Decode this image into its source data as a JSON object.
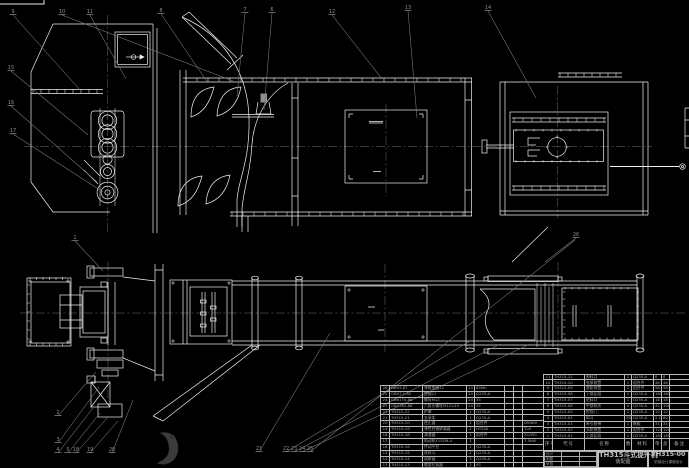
{
  "drawing": {
    "colors": {
      "background": "#000000",
      "line": "#f0f0f0",
      "leader": "#7d7d7d",
      "text": "#a6a6a6"
    },
    "watermark": "ink-blot-logo"
  },
  "title_block": {
    "title": "TH315斗式提升机",
    "subtitle": "装配图",
    "drawing_no": "TH315-00",
    "org_line": "机械设计课程设计",
    "sign_labels": [
      "设计",
      "制图",
      "审核"
    ]
  },
  "bom": {
    "headers": [
      "序号",
      "代号",
      "名称",
      "数量",
      "材料",
      "单件",
      "总计",
      "备注"
    ],
    "right_rows": [
      [
        "11",
        "TH315-11",
        "卸料口",
        "1",
        "Q235-A",
        "8",
        "8",
        ""
      ],
      [
        "10",
        "TH315-10",
        "张紧装置",
        "1",
        "组合件",
        "46",
        "46",
        ""
      ],
      [
        "9",
        "TH315-09",
        "底轮装置",
        "1",
        "组合件",
        "58",
        "58",
        ""
      ],
      [
        "8",
        "TH315-08",
        "下部区段",
        "1",
        "Q235-A",
        "165",
        "165",
        ""
      ],
      [
        "7",
        "TH315-07",
        "进料口",
        "1",
        "Q235-A",
        "18",
        "18",
        ""
      ],
      [
        "6",
        "TH315-06",
        "中部机壳",
        "4",
        "Q235-A",
        "42",
        "168",
        ""
      ],
      [
        "5",
        "TH315-05",
        "检视门",
        "1",
        "Q235-A",
        "12",
        "12",
        ""
      ],
      [
        "4",
        "TH315-04",
        "料斗",
        "38",
        "Q235-A",
        "2.1",
        "80",
        ""
      ],
      [
        "3",
        "TH315-03",
        "牵引胶带",
        "1",
        "橡胶",
        "35",
        "35",
        ""
      ],
      [
        "2",
        "TH315-02",
        "头轮装置",
        "1",
        "组合件",
        "120",
        "120",
        ""
      ],
      [
        "1",
        "TH315-01",
        "上部区段",
        "1",
        "Q235-A",
        "185",
        "185",
        ""
      ]
    ],
    "left_rows": [
      [
        "26",
        "GB93-87",
        "弹簧垫圈12",
        "24",
        "65Mn",
        "",
        "",
        ""
      ],
      [
        "25",
        "GB97.1-85",
        "垫圈12",
        "24",
        "Q235-A",
        "",
        "",
        ""
      ],
      [
        "24",
        "GB6170-86",
        "螺母M12",
        "24",
        "35",
        "",
        "",
        ""
      ],
      [
        "23",
        "GB5782-86",
        "六角头螺栓M12×45",
        "24",
        "35",
        "",
        "",
        ""
      ],
      [
        "22",
        "TH315-22",
        "护罩",
        "1",
        "Q235-A",
        "",
        "",
        ""
      ],
      [
        "21",
        "TH315-21",
        "支承架",
        "1",
        "Q235-A",
        "",
        "",
        ""
      ],
      [
        "20",
        "TH315-20",
        "逆止器",
        "1",
        "组合件",
        "",
        "",
        "DSN60"
      ],
      [
        "19",
        "TH315-19",
        "弹性柱销联轴器",
        "1",
        "HT200",
        "",
        "",
        "TL6"
      ],
      [
        "18",
        "TH315-18",
        "减速器",
        "1",
        "组合件",
        "",
        "",
        "ZQ350"
      ],
      [
        "17",
        "",
        "电动机Y132M-4",
        "1",
        "",
        "",
        "",
        "7.5kW"
      ],
      [
        "16",
        "TH315-16",
        "传动平台",
        "1",
        "Q235-A",
        "",
        "",
        ""
      ],
      [
        "15",
        "TH315-15",
        "进料斗",
        "1",
        "Q235-A",
        "",
        "",
        ""
      ],
      [
        "14",
        "TH315-14",
        "观察窗",
        "2",
        "Q235-A",
        "",
        "",
        ""
      ],
      [
        "13",
        "TH315-13",
        "螺旋拉紧器",
        "2",
        "45",
        "",
        "",
        ""
      ],
      [
        "12",
        "TH315-12",
        "盖板",
        "1",
        "Q235-A",
        "",
        "",
        ""
      ]
    ]
  },
  "callouts": [
    {
      "label": "9",
      "x": 13,
      "y": 13,
      "tx": 80,
      "ty": 90
    },
    {
      "label": "10",
      "x": 62,
      "y": 13,
      "tx": 233,
      "ty": 81
    },
    {
      "label": "11",
      "x": 90,
      "y": 13,
      "tx": 126,
      "ty": 79
    },
    {
      "label": "8",
      "x": 161,
      "y": 12,
      "tx": 208,
      "ty": 83
    },
    {
      "label": "7",
      "x": 245,
      "y": 11,
      "tx": 237,
      "ty": 96
    },
    {
      "label": "6",
      "x": 272,
      "y": 11,
      "tx": 264,
      "ty": 110
    },
    {
      "label": "12",
      "x": 332,
      "y": 13,
      "tx": 382,
      "ty": 79
    },
    {
      "label": "13",
      "x": 408,
      "y": 9,
      "tx": 417,
      "ty": 118
    },
    {
      "label": "14",
      "x": 488,
      "y": 9,
      "tx": 536,
      "ty": 98
    },
    {
      "label": "15",
      "x": 11,
      "y": 69,
      "tx": 88,
      "ty": 135
    },
    {
      "label": "16",
      "x": 11,
      "y": 104,
      "tx": 97,
      "ty": 182
    },
    {
      "label": "17",
      "x": 13,
      "y": 132,
      "tx": 103,
      "ty": 192
    },
    {
      "label": "1",
      "x": 75,
      "y": 239,
      "tx": 103,
      "ty": 271
    },
    {
      "label": "2",
      "x": 58,
      "y": 414,
      "tx": 96,
      "ty": 372
    },
    {
      "label": "3",
      "x": 58,
      "y": 441,
      "tx": 99,
      "ty": 387
    },
    {
      "label": "4",
      "x": 58,
      "y": 451,
      "tx": 93,
      "ty": 408
    },
    {
      "label": "5",
      "x": 68,
      "y": 451,
      "tx": 100,
      "ty": 413
    },
    {
      "label": "18",
      "x": 76,
      "y": 451,
      "tx": 108,
      "ty": 417
    },
    {
      "label": "19",
      "x": 90,
      "y": 451,
      "tx": 118,
      "ty": 421
    },
    {
      "label": "20",
      "x": 112,
      "y": 451,
      "tx": 133,
      "ty": 400
    },
    {
      "label": "21",
      "x": 259,
      "y": 450,
      "tx": 330,
      "ty": 333
    },
    {
      "label": "22",
      "x": 286,
      "y": 450,
      "tx": 470,
      "ty": 341
    },
    {
      "label": "23",
      "x": 294,
      "y": 450,
      "tx": 500,
      "ty": 344
    },
    {
      "label": "24",
      "x": 302,
      "y": 450,
      "tx": 530,
      "ty": 344
    },
    {
      "label": "25",
      "x": 310,
      "y": 450,
      "tx": 575,
      "ty": 240
    },
    {
      "label": "26",
      "x": 576,
      "y": 236,
      "tx": 545,
      "ty": 262
    }
  ]
}
